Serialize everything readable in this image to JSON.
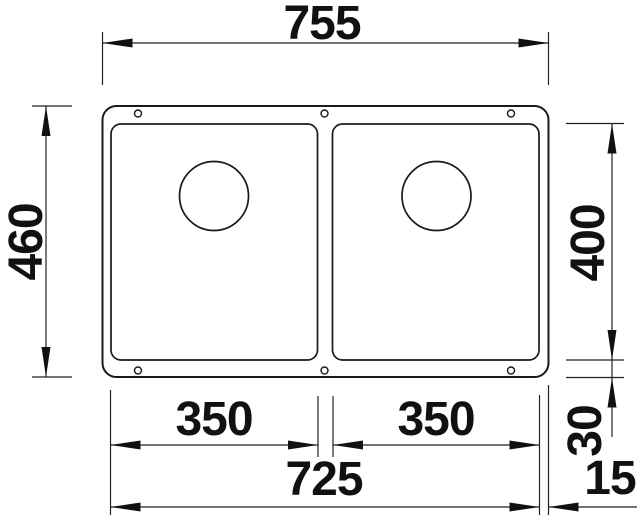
{
  "drawing": {
    "kind": "technical-dimension-drawing",
    "dimensions": {
      "overall_width": "755",
      "overall_depth": "460",
      "bowl_depth": "400",
      "left_bowl_width": "350",
      "right_bowl_width": "350",
      "bowl_span_width": "725",
      "bottom_rim": "30",
      "side_rim": "15"
    },
    "colors": {
      "outline": "#1a1a1a",
      "dimension": "#111111",
      "background": "#ffffff"
    }
  }
}
